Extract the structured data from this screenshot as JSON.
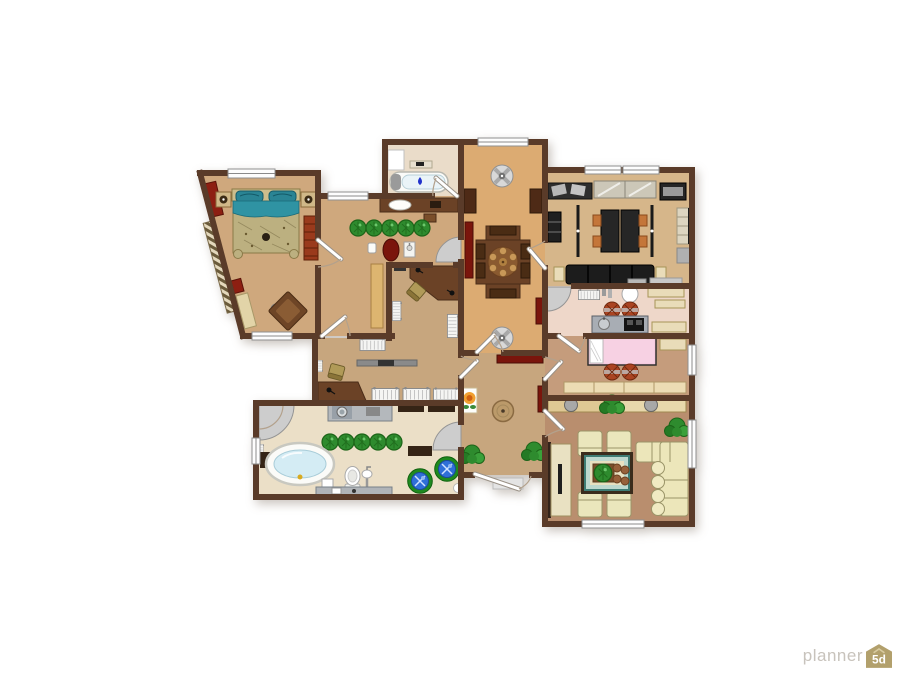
{
  "watermark": {
    "brand": "planner",
    "badge": "5d"
  },
  "palette": {
    "background": "#ffffff",
    "wall": "#5a3b29",
    "floor_bedroom": "#cfa87d",
    "floor_small_bath": "#eadcc9",
    "floor_dining": "#dcab72",
    "floor_office": "#d6b68a",
    "floor_kitchen": "#eed7c9",
    "floor_kids": "#c59c7c",
    "floor_living": "#b98e6e",
    "floor_hall": "#c7a67e",
    "floor_workroom": "#c7a67e",
    "floor_main_bath": "#ebdfc7",
    "accent_red": "#7a150c",
    "plant_green": "#2e8b2e",
    "bed_teal": "#2f93a3",
    "bed_pink": "#f6cade",
    "sofa_cream": "#eae6bc",
    "stool_blue": "#2f6fd8",
    "stool_orange": "#aa4422",
    "wood_brown": "#6b4226",
    "watermark_text": "#c8c3bc",
    "watermark_badge": "#b2a06c"
  },
  "rooms": [
    {
      "id": "master-bedroom",
      "furniture": [
        "double-bed",
        "nightstand-left",
        "nightstand-right",
        "red-wardrobe",
        "red-dresser",
        "armchair",
        "side-table",
        "bench",
        "wall-ladder"
      ]
    },
    {
      "id": "dressing-hall",
      "furniture": [
        "vanity-sink",
        "plant-row",
        "laundry-basket",
        "small-sink",
        "trash-bin",
        "tall-cabinet"
      ]
    },
    {
      "id": "small-bathroom",
      "furniture": [
        "bathtub",
        "shelf",
        "cabinet"
      ]
    },
    {
      "id": "dining-room",
      "furniture": [
        "dining-table",
        "chairs",
        "benches",
        "ceiling-fan-top",
        "ceiling-fan-bottom",
        "red-sideboard",
        "wall-cabinets"
      ]
    },
    {
      "id": "home-office",
      "furniture": [
        "double-desk",
        "office-chairs",
        "sliding-wardrobe",
        "bookshelf",
        "shelf-unit",
        "dark-sofa",
        "lamp-rails"
      ]
    },
    {
      "id": "kitchen",
      "furniture": [
        "counter-sink-stove",
        "radiator",
        "stools",
        "shelves",
        "vase"
      ]
    },
    {
      "id": "kids-bedroom",
      "furniture": [
        "pink-bed",
        "stools",
        "dresser",
        "shelf"
      ]
    },
    {
      "id": "living-room",
      "furniture": [
        "armchair-group",
        "coffee-table",
        "corner-sofa",
        "tv-stand",
        "dressers",
        "plants"
      ]
    },
    {
      "id": "entrance-hall",
      "furniture": [
        "round-table",
        "flower-picture",
        "bushes",
        "red-buffet",
        "entry-step"
      ]
    },
    {
      "id": "workroom",
      "furniture": [
        "corner-desk",
        "desk",
        "office-chairs",
        "radiators",
        "wall-bar"
      ]
    },
    {
      "id": "main-bathroom",
      "furniture": [
        "oval-bathtub",
        "toilet",
        "pedestal-sink",
        "bidet-box",
        "washer-counter",
        "plant-row",
        "blue-stools",
        "corner-shower",
        "vanity-counter",
        "wall-cabinets"
      ]
    }
  ]
}
